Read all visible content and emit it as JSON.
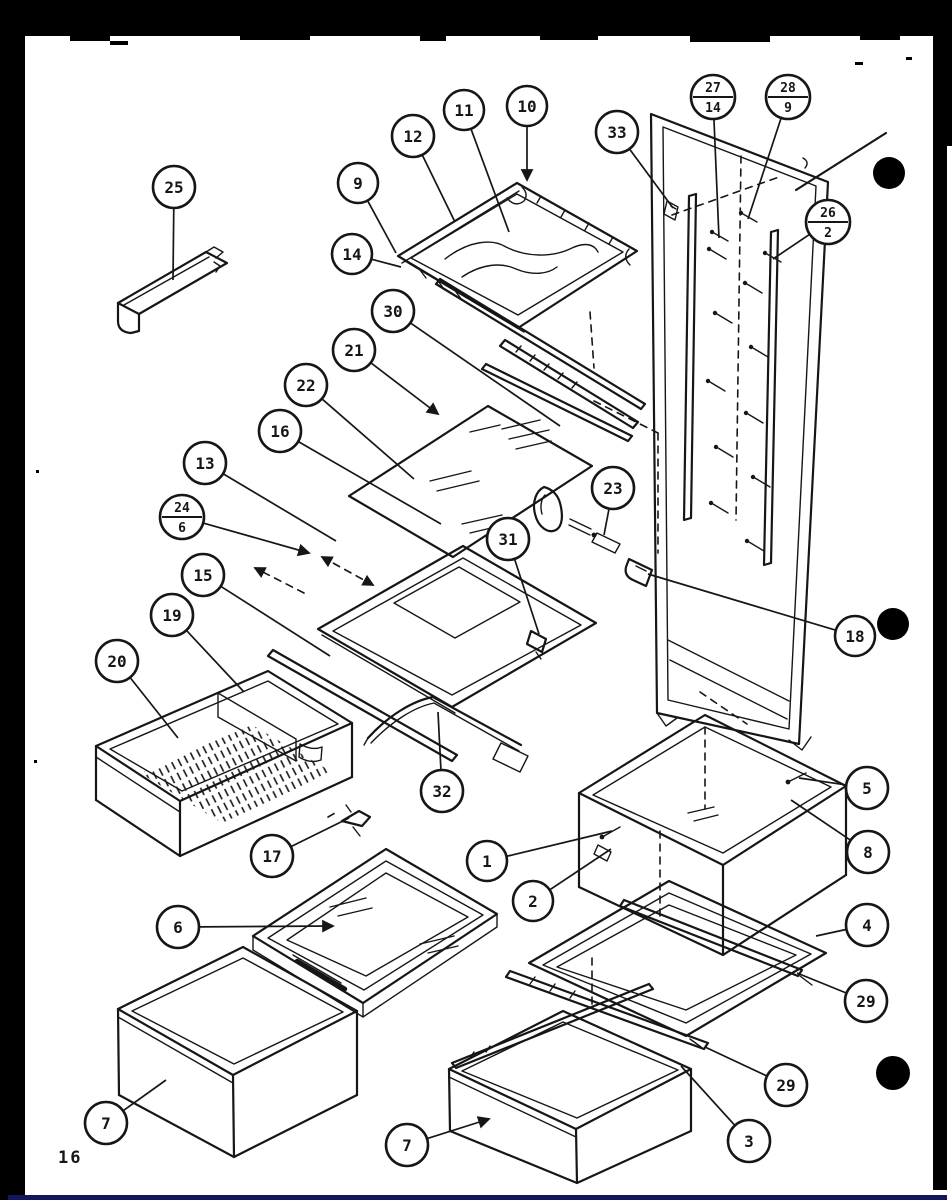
{
  "page": {
    "number": "16"
  },
  "colors": {
    "ink": "#161616",
    "paper": "#ffffff",
    "mask": "#000000",
    "rule": "#15155a"
  },
  "callouts": [
    {
      "id": "25",
      "label": "25",
      "x": 174,
      "y": 187,
      "r": 21,
      "lx": 173,
      "ly": 280
    },
    {
      "id": "12",
      "label": "12",
      "x": 413,
      "y": 136,
      "r": 21,
      "lx": 455,
      "ly": 222
    },
    {
      "id": "11",
      "label": "11",
      "x": 464,
      "y": 110,
      "r": 20,
      "lx": 509,
      "ly": 232
    },
    {
      "id": "10",
      "label": "10",
      "x": 527,
      "y": 106,
      "r": 20,
      "lx": 527,
      "ly": 180,
      "arrow": true
    },
    {
      "id": "9",
      "label": "9",
      "x": 358,
      "y": 183,
      "r": 20,
      "lx": 396,
      "ly": 253
    },
    {
      "id": "14",
      "label": "14",
      "x": 352,
      "y": 254,
      "r": 20,
      "lx": 401,
      "ly": 267
    },
    {
      "id": "33",
      "label": "33",
      "x": 617,
      "y": 132,
      "r": 21,
      "lx": 673,
      "ly": 208
    },
    {
      "id": "27-14",
      "top": "27",
      "bottom": "14",
      "x": 713,
      "y": 97,
      "r": 22,
      "lx": 719,
      "ly": 238
    },
    {
      "id": "28-9",
      "top": "28",
      "bottom": "9",
      "x": 788,
      "y": 97,
      "r": 22,
      "lx": 748,
      "ly": 219
    },
    {
      "id": "26-2",
      "top": "26",
      "bottom": "2",
      "x": 828,
      "y": 222,
      "r": 22,
      "lx": 773,
      "ly": 259
    },
    {
      "id": "30",
      "label": "30",
      "x": 393,
      "y": 311,
      "r": 21,
      "lx": 560,
      "ly": 426
    },
    {
      "id": "21",
      "label": "21",
      "x": 354,
      "y": 350,
      "r": 21,
      "lx": 438,
      "ly": 414,
      "arrow": true
    },
    {
      "id": "22",
      "label": "22",
      "x": 306,
      "y": 385,
      "r": 21,
      "lx": 414,
      "ly": 479
    },
    {
      "id": "16",
      "label": "16",
      "x": 280,
      "y": 431,
      "r": 21,
      "lx": 441,
      "ly": 524
    },
    {
      "id": "13",
      "label": "13",
      "x": 205,
      "y": 463,
      "r": 21,
      "lx": 336,
      "ly": 541
    },
    {
      "id": "24-6",
      "top": "24",
      "bottom": "6",
      "x": 182,
      "y": 517,
      "r": 22,
      "lx": 309,
      "ly": 553,
      "arrow": true
    },
    {
      "id": "15",
      "label": "15",
      "x": 203,
      "y": 575,
      "r": 21,
      "lx": 330,
      "ly": 656
    },
    {
      "id": "23",
      "label": "23",
      "x": 613,
      "y": 488,
      "r": 21,
      "lx": 604,
      "ly": 535
    },
    {
      "id": "31",
      "label": "31",
      "x": 508,
      "y": 539,
      "r": 21,
      "lx": 539,
      "ly": 634
    },
    {
      "id": "18",
      "label": "18",
      "x": 855,
      "y": 636,
      "r": 20,
      "lx": 648,
      "ly": 574
    },
    {
      "id": "19",
      "label": "19",
      "x": 172,
      "y": 615,
      "r": 21,
      "lx": 244,
      "ly": 692
    },
    {
      "id": "20",
      "label": "20",
      "x": 117,
      "y": 661,
      "r": 21,
      "lx": 178,
      "ly": 738
    },
    {
      "id": "32",
      "label": "32",
      "x": 442,
      "y": 791,
      "r": 21,
      "lx": 438,
      "ly": 712
    },
    {
      "id": "17",
      "label": "17",
      "x": 272,
      "y": 856,
      "r": 21,
      "lx": 349,
      "ly": 818
    },
    {
      "id": "1",
      "label": "1",
      "x": 487,
      "y": 861,
      "r": 20,
      "lx": 612,
      "ly": 831
    },
    {
      "id": "6",
      "label": "6",
      "x": 178,
      "y": 927,
      "r": 21,
      "lx": 333,
      "ly": 926,
      "arrow": true
    },
    {
      "id": "2",
      "label": "2",
      "x": 533,
      "y": 901,
      "r": 20,
      "lx": 611,
      "ly": 849
    },
    {
      "id": "5",
      "label": "5",
      "x": 867,
      "y": 788,
      "r": 21,
      "lx": 799,
      "ly": 778
    },
    {
      "id": "8",
      "label": "8",
      "x": 868,
      "y": 852,
      "r": 21,
      "lx": 791,
      "ly": 800
    },
    {
      "id": "4",
      "label": "4",
      "x": 867,
      "y": 925,
      "r": 21,
      "lx": 816,
      "ly": 936
    },
    {
      "id": "29a",
      "label": "29",
      "x": 866,
      "y": 1001,
      "r": 21,
      "lx": 797,
      "ly": 973
    },
    {
      "id": "29b",
      "label": "29",
      "x": 786,
      "y": 1085,
      "r": 21,
      "lx": 705,
      "ly": 1047
    },
    {
      "id": "3",
      "label": "3",
      "x": 749,
      "y": 1141,
      "r": 21,
      "lx": 681,
      "ly": 1066
    },
    {
      "id": "7a",
      "label": "7",
      "x": 106,
      "y": 1123,
      "r": 21,
      "lx": 166,
      "ly": 1080
    },
    {
      "id": "7b",
      "label": "7",
      "x": 407,
      "y": 1145,
      "r": 21,
      "lx": 489,
      "ly": 1119,
      "arrow": true
    }
  ],
  "dots": [
    {
      "x": 889,
      "y": 173,
      "r": 16
    },
    {
      "x": 893,
      "y": 624,
      "r": 16
    },
    {
      "x": 893,
      "y": 1073,
      "r": 17
    }
  ]
}
